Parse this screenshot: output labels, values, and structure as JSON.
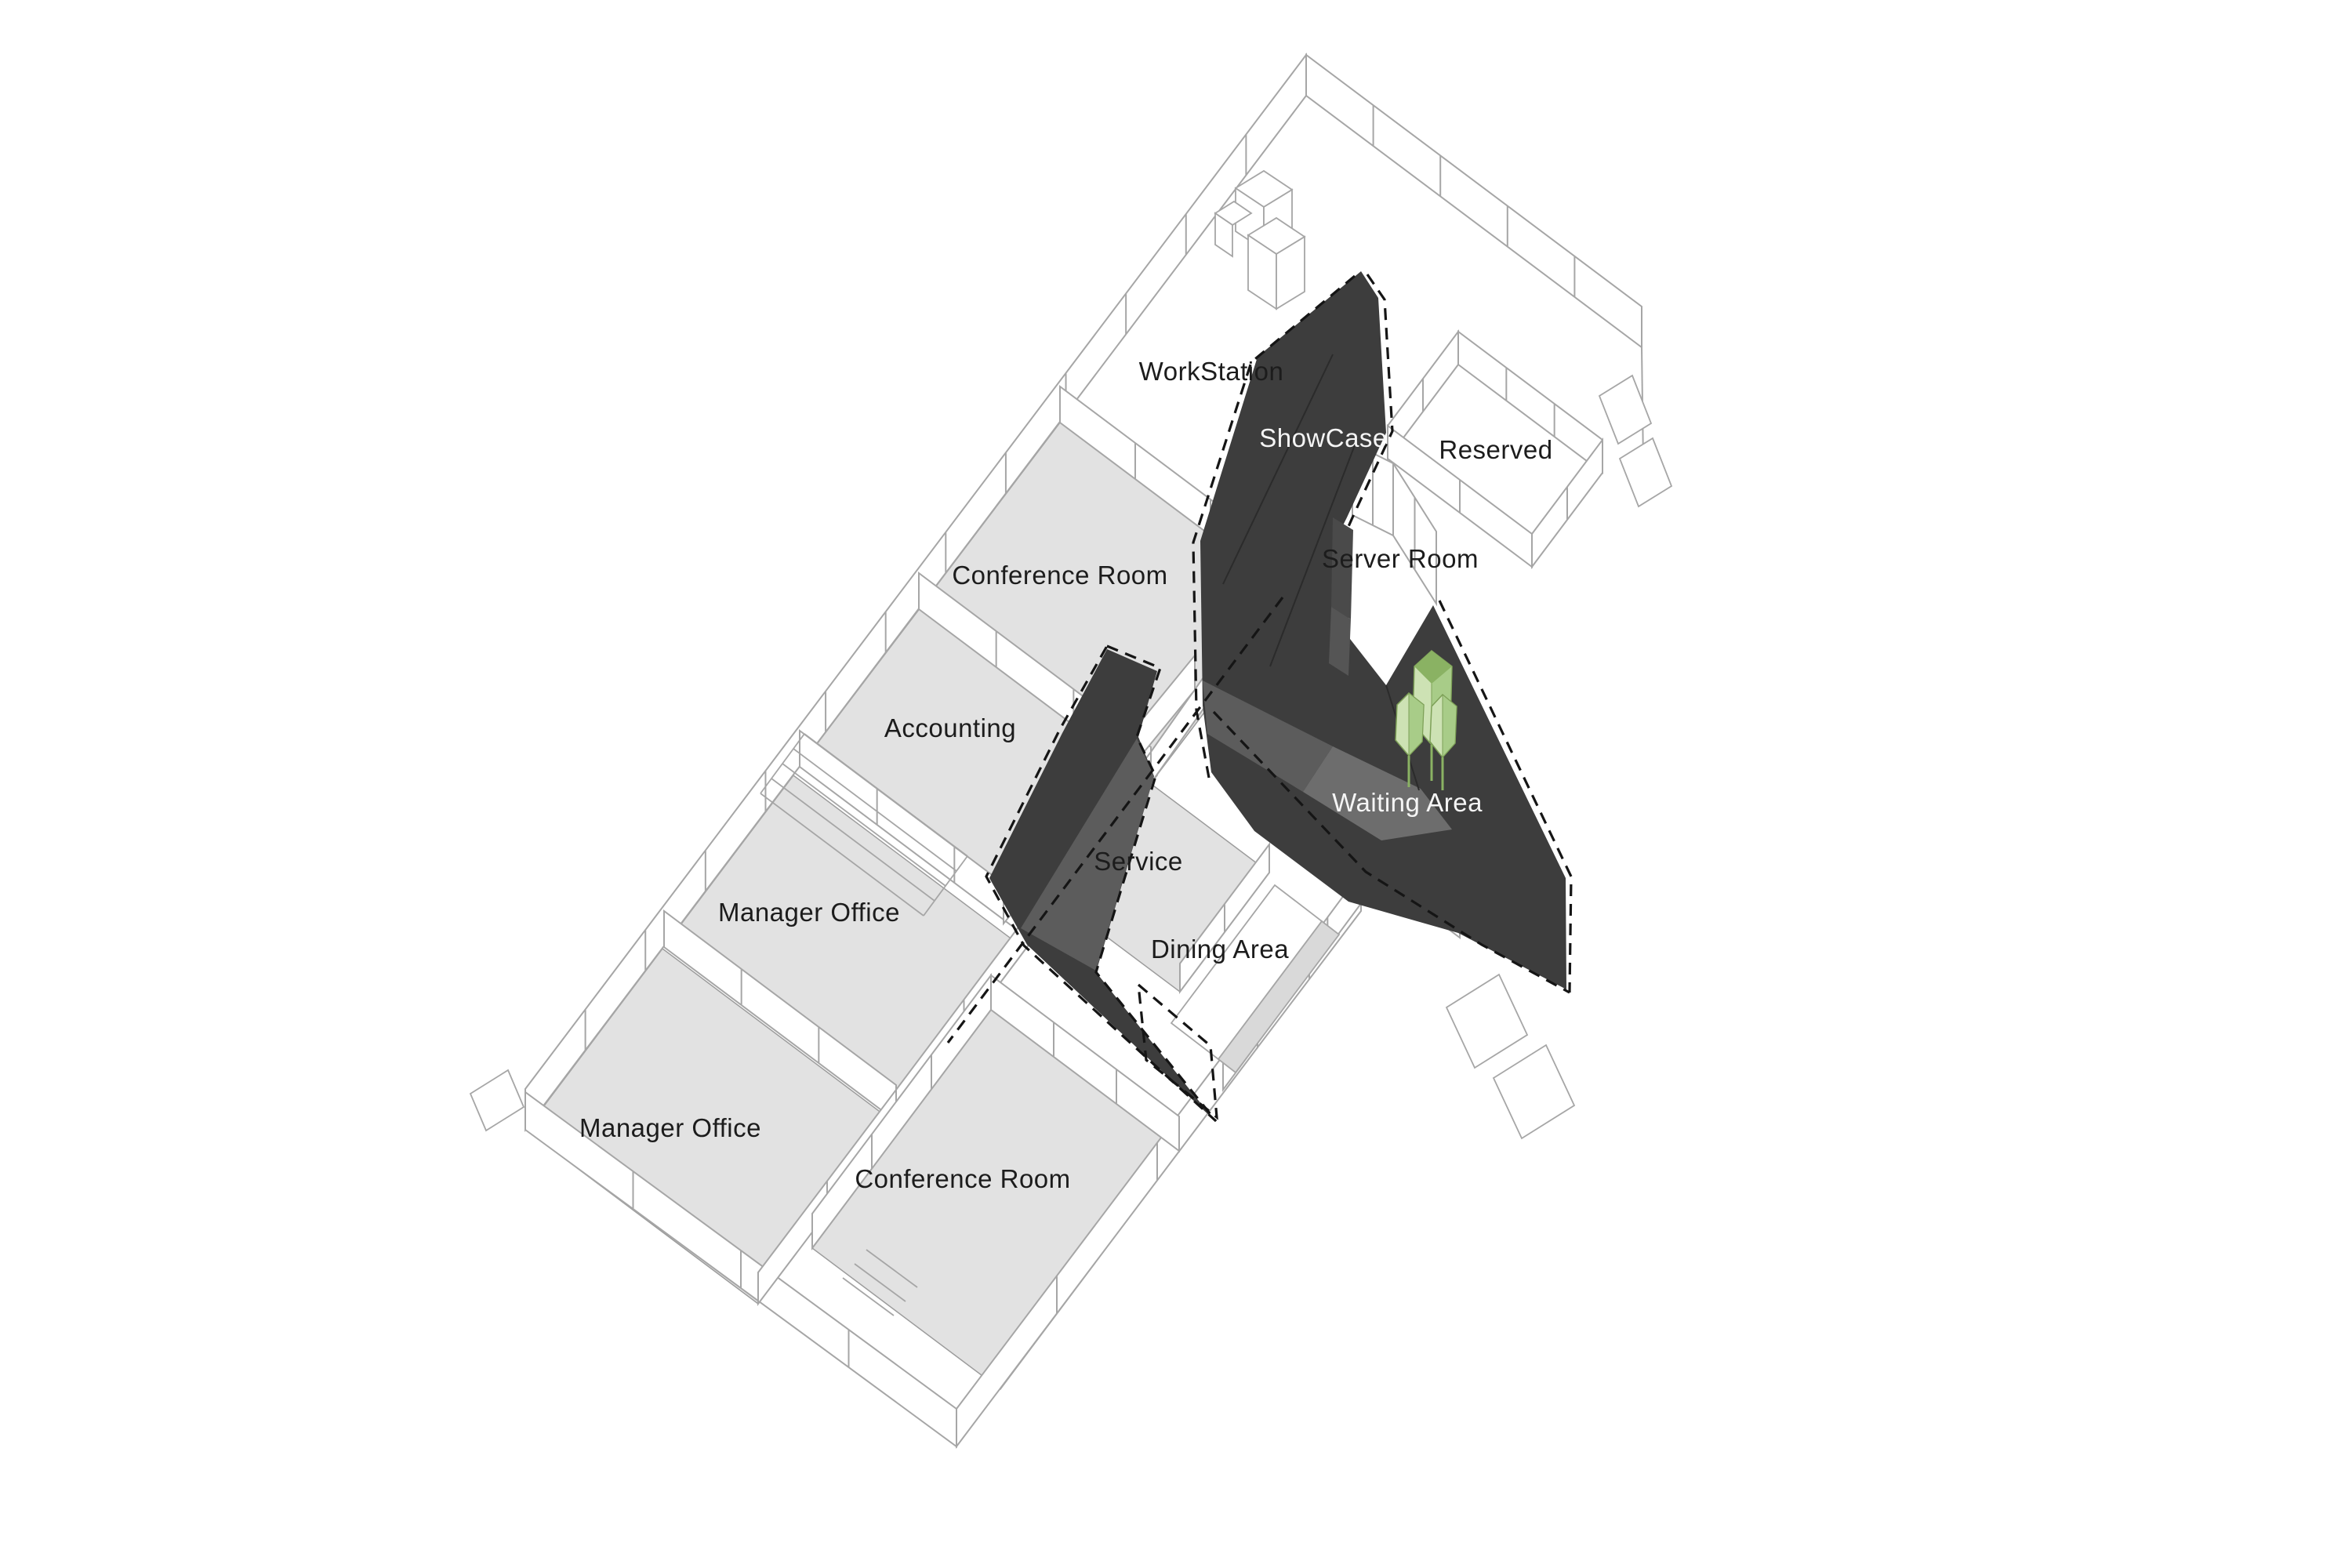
{
  "diagram": {
    "type": "axonometric-floor-plan",
    "rooms": [
      {
        "id": "workstation",
        "label": "WorkStation",
        "label_style": "dark"
      },
      {
        "id": "showcase",
        "label": "ShowCase",
        "label_style": "light"
      },
      {
        "id": "reserved",
        "label": "Reserved",
        "label_style": "dark"
      },
      {
        "id": "server-room",
        "label": "Server Room",
        "label_style": "dark"
      },
      {
        "id": "conference-room-upper",
        "label": "Conference Room",
        "label_style": "dark"
      },
      {
        "id": "accounting",
        "label": "Accounting",
        "label_style": "dark"
      },
      {
        "id": "manager-office-upper",
        "label": "Manager Office",
        "label_style": "dark"
      },
      {
        "id": "manager-office-lower",
        "label": "Manager Office",
        "label_style": "dark"
      },
      {
        "id": "conference-room-lower",
        "label": "Conference Room",
        "label_style": "dark"
      },
      {
        "id": "service",
        "label": "Service",
        "label_style": "dark"
      },
      {
        "id": "dining-area",
        "label": "Dining Area",
        "label_style": "dark"
      },
      {
        "id": "waiting-area",
        "label": "Waiting Area",
        "label_style": "light"
      }
    ]
  },
  "colors": {
    "background": "#ffffff",
    "wireframe": "#a6a6a6",
    "wall_fill": "#ffffff",
    "floor_gray": "#e2e2e2",
    "floor_stroke": "#9c9c9c",
    "ribbon_dark": "#3d3d3d",
    "ribbon_mid": "#5c5c5c",
    "ribbon_light": "#6d6d6d",
    "shelf_dark": "#4a4a4a",
    "shelf_mid": "#555555",
    "ridge_line": "#2b2b2b",
    "dashed_outline": "#151515",
    "table_side": "#d9d9d9",
    "tree_light": "#cde2b4",
    "tree_mid": "#a8cc88",
    "tree_dark": "#8ab263",
    "tree_stroke": "#7da057",
    "label_dark": "#1c1c1c",
    "label_light": "#f5f5f5"
  }
}
